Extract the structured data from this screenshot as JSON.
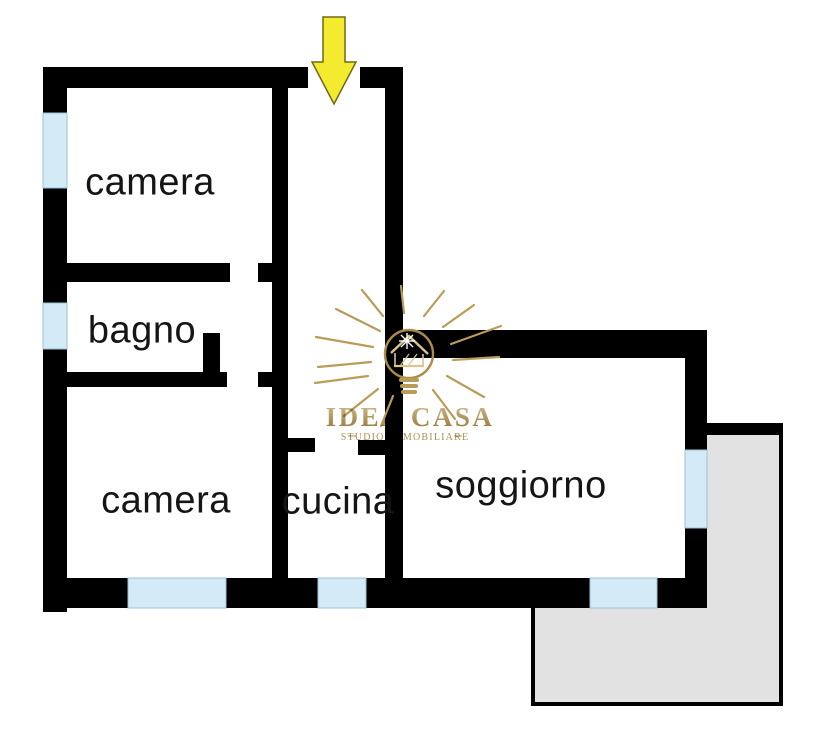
{
  "colors": {
    "wall": "#000000",
    "window": "#d2ebf7",
    "balcony": "#e2e2e2",
    "arrow": "#f4eb2f",
    "arrow_outline": "#6b6b1a",
    "gold": "#ab8c48",
    "gold_light": "#d9c48c",
    "text_color": "#151515",
    "background": "#ffffff"
  },
  "rooms": [
    {
      "id": "camera-1",
      "label": "camera",
      "cx": 150,
      "cy": 183
    },
    {
      "id": "bagno",
      "label": "bagno",
      "cx": 142,
      "cy": 331
    },
    {
      "id": "camera-2",
      "label": "camera",
      "cx": 166,
      "cy": 501
    },
    {
      "id": "cucina",
      "label": "cucina",
      "cx": 338,
      "cy": 502
    },
    {
      "id": "soggiorno",
      "label": "soggiorno",
      "cx": 521,
      "cy": 486
    }
  ],
  "watermark": {
    "brand": "IDEA CASA",
    "tagline": "STUDIO IMMOBILIARE"
  },
  "plan": {
    "walls": [
      {
        "name": "top-wall",
        "x": 43,
        "y": 67,
        "w": 265,
        "h": 21
      },
      {
        "name": "top-wall-right-cap",
        "x": 360,
        "y": 67,
        "w": 43,
        "h": 21
      },
      {
        "name": "left-wall",
        "x": 43,
        "y": 67,
        "w": 24,
        "h": 545
      },
      {
        "name": "bottom-wall",
        "x": 43,
        "y": 578,
        "w": 664,
        "h": 30
      },
      {
        "name": "hall-left-wall",
        "x": 272,
        "y": 88,
        "w": 16,
        "h": 490
      },
      {
        "name": "hall-right-wall",
        "x": 385,
        "y": 88,
        "w": 18,
        "h": 490
      },
      {
        "name": "camera1-bottom-wall",
        "x": 67,
        "y": 263,
        "w": 163,
        "h": 19
      },
      {
        "name": "camera1-bottom-wall-b",
        "x": 258,
        "y": 263,
        "w": 30,
        "h": 19
      },
      {
        "name": "bagno-bottom-wall",
        "x": 43,
        "y": 372,
        "w": 184,
        "h": 15
      },
      {
        "name": "bagno-door-jamb",
        "x": 203,
        "y": 333,
        "w": 17,
        "h": 54
      },
      {
        "name": "alcove-stub",
        "x": 258,
        "y": 372,
        "w": 30,
        "h": 15
      },
      {
        "name": "cucina-top-wall-a",
        "x": 288,
        "y": 438,
        "w": 27,
        "h": 14
      },
      {
        "name": "cucina-top-wall-b",
        "x": 358,
        "y": 440,
        "w": 27,
        "h": 15
      },
      {
        "name": "soggiorno-top-wall",
        "x": 403,
        "y": 330,
        "w": 304,
        "h": 28
      },
      {
        "name": "soggiorno-right-wall",
        "x": 685,
        "y": 330,
        "w": 22,
        "h": 248
      },
      {
        "name": "balcony-top-edge",
        "x": 703,
        "y": 425,
        "w": 78,
        "h": 10
      }
    ],
    "windows": [
      {
        "name": "camera1-window",
        "x": 43,
        "y": 113,
        "w": 24,
        "h": 75
      },
      {
        "name": "bagno-window",
        "x": 43,
        "y": 303,
        "w": 24,
        "h": 46
      },
      {
        "name": "camera2-window",
        "x": 128,
        "y": 578,
        "w": 98,
        "h": 30
      },
      {
        "name": "cucina-window",
        "x": 318,
        "y": 578,
        "w": 48,
        "h": 30
      },
      {
        "name": "soggiorno-bottom-window",
        "x": 590,
        "y": 578,
        "w": 67,
        "h": 30
      },
      {
        "name": "soggiorno-right-window",
        "x": 685,
        "y": 450,
        "w": 22,
        "h": 78
      }
    ],
    "balcony": {
      "points": "703,425 781,425 781,704 533,704 533,603 703,603"
    },
    "entrance_arrow": {
      "points": "323,17 345,17 345,62 356,62 334,104 312,62 323,62"
    }
  }
}
